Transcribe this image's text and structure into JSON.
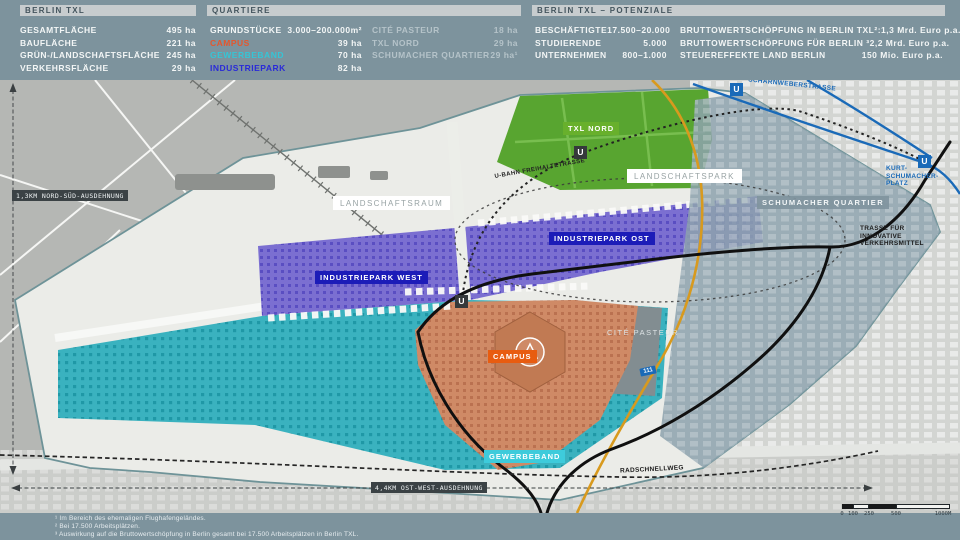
{
  "colors": {
    "header_bg": "#7D939D",
    "title_bar_bg": "#C7CCCE",
    "campus": "#E4572E",
    "gewerbeband": "#35C5D6",
    "industriepark": "#2424CE",
    "txl_nord_green": "#58A530",
    "schumacher_overlay": "#8DA2AD",
    "road_blue": "#1A6AB8",
    "road_orange": "#D89A1E",
    "trasse_black": "#101010"
  },
  "header": {
    "panel_txl": {
      "title": "BERLIN TXL",
      "rows": [
        {
          "label": "GESAMTFLÄCHE",
          "value": "495 ha"
        },
        {
          "label": "BAUFLÄCHE",
          "value": "221 ha"
        },
        {
          "label": "GRÜN-/LANDSCHAFTSFLÄCHE",
          "value": "245 ha"
        },
        {
          "label": "VERKEHRSFLÄCHE",
          "value": "29 ha"
        }
      ]
    },
    "panel_quartiere": {
      "title": "QUARTIERE",
      "left": [
        {
          "label": "GRUNDSTÜCKE",
          "value": "3.000–200.000m²"
        },
        {
          "label": "CAMPUS",
          "value": "39 ha"
        },
        {
          "label": "GEWERBEBAND",
          "value": "70 ha"
        },
        {
          "label": "INDUSTRIEPARK",
          "value": "82 ha"
        }
      ],
      "right": [
        {
          "label": "CITÉ PASTEUR",
          "value": "18 ha"
        },
        {
          "label": "TXL NORD",
          "value": "29 ha"
        },
        {
          "label": "SCHUMACHER QUARTIER",
          "value": "29 ha¹"
        }
      ]
    },
    "panel_potenziale": {
      "title": "BERLIN TXL – POTENZIALE",
      "left": [
        {
          "label": "BESCHÄFTIGTE",
          "value": "17.500–20.000"
        },
        {
          "label": "STUDIERENDE",
          "value": "5.000"
        },
        {
          "label": "UNTERNEHMEN",
          "value": "800–1.000"
        }
      ],
      "right": [
        {
          "label": "BRUTTOWERTSCHÖPFUNG IN BERLIN TXL²:",
          "value": "1,3 Mrd. Euro p.a."
        },
        {
          "label": "BRUTTOWERTSCHÖPFUNG FÜR BERLIN ³",
          "value": "2,2 Mrd. Euro p.a."
        },
        {
          "label": "STEUEREFFEKTE LAND BERLIN",
          "value": "150 Mio. Euro p.a."
        }
      ]
    }
  },
  "map": {
    "area_labels": {
      "landschaftsraum": "LANDSCHAFTSRAUM",
      "landschaftspark": "LANDSCHAFTSPARK",
      "txl_nord": "TXL NORD",
      "industriepark_ost": "INDUSTRIEPARK OST",
      "industriepark_west": "INDUSTRIEPARK WEST",
      "campus": "CAMPUS",
      "gewerbeband": "GEWERBEBAND",
      "schumacher_quartier": "SCHUMACHER QUARTIER",
      "cite_pasteur": "CITÉ PASTEUR"
    },
    "streets": {
      "scharnweberstrasse": "SCHARNWEBERSTRASSE",
      "kurt_schumacher_platz": "KURT-\nSCHUMACHER-\nPLATZ",
      "trasse": "TRASSE FÜR\nINNOVATIVE\nVERKEHRSMITTEL",
      "radschnellweg": "RADSCHNELLWEG",
      "ubahn_freihaltetrasse": "U-BAHN FREIHALTETRASSE"
    },
    "dimensions": {
      "north_south": "1,3KM NORD-SÜD-AUSDEHNUNG",
      "ost_west": "4,4KM OST-WEST-AUSDEHNUNG"
    },
    "station_label": "U",
    "road_badge": "111",
    "scale_ticks": [
      "0",
      "100",
      "250",
      "500",
      "1000M"
    ]
  },
  "footnotes": [
    "¹ Im Bereich des ehemaligen Flughafengeländes.",
    "² Bei 17.500 Arbeitsplätzen.",
    "³ Auswirkung auf die Bruttowertschöpfung in Berlin gesamt bei 17.500 Arbeitsplätzen in Berlin TXL."
  ]
}
